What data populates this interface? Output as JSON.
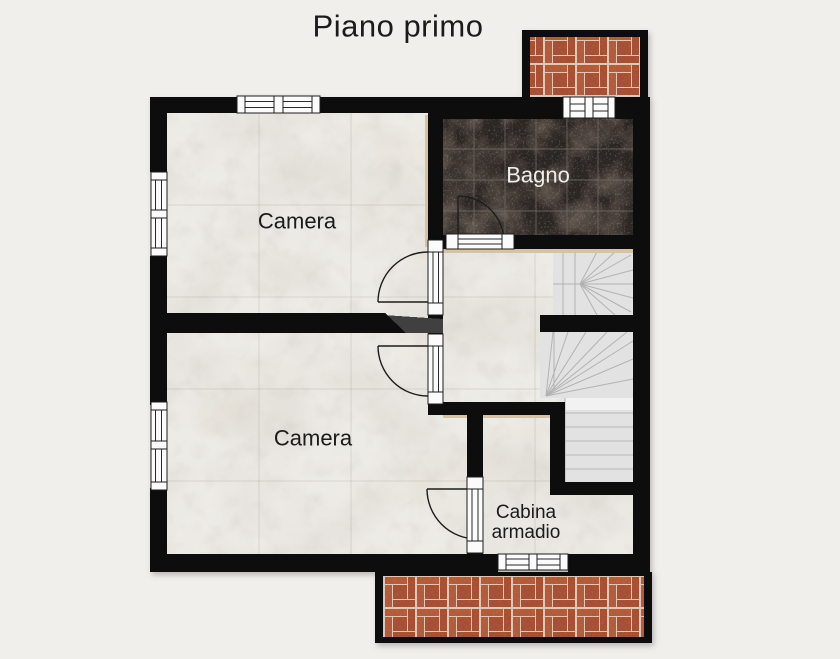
{
  "title": "Piano primo",
  "rooms": {
    "camera_top": {
      "label": "Camera"
    },
    "bagno": {
      "label": "Bagno"
    },
    "camera_bottom": {
      "label": "Camera"
    },
    "cabina_armadio": {
      "line1": "Cabina",
      "line2": "armadio"
    }
  },
  "colors": {
    "background": "#f0efeb",
    "wall": "#0b0a09",
    "marble_base": "#edebe6",
    "tile_base": "#2b2523",
    "tile_grid": "#6f6b65",
    "brick": "#b45a3a",
    "brick_dark": "#a64f33",
    "brick_mortar": "#dbc8b8",
    "stair": "#e2e2e2",
    "stair_line": "#b2b2b2",
    "trim_tan": "#d5c3a4",
    "door_white": "#fbfbfb",
    "label_dark": "#1b1b1b",
    "label_light": "#f0eeeb",
    "watermark": "#3f3f3f"
  }
}
